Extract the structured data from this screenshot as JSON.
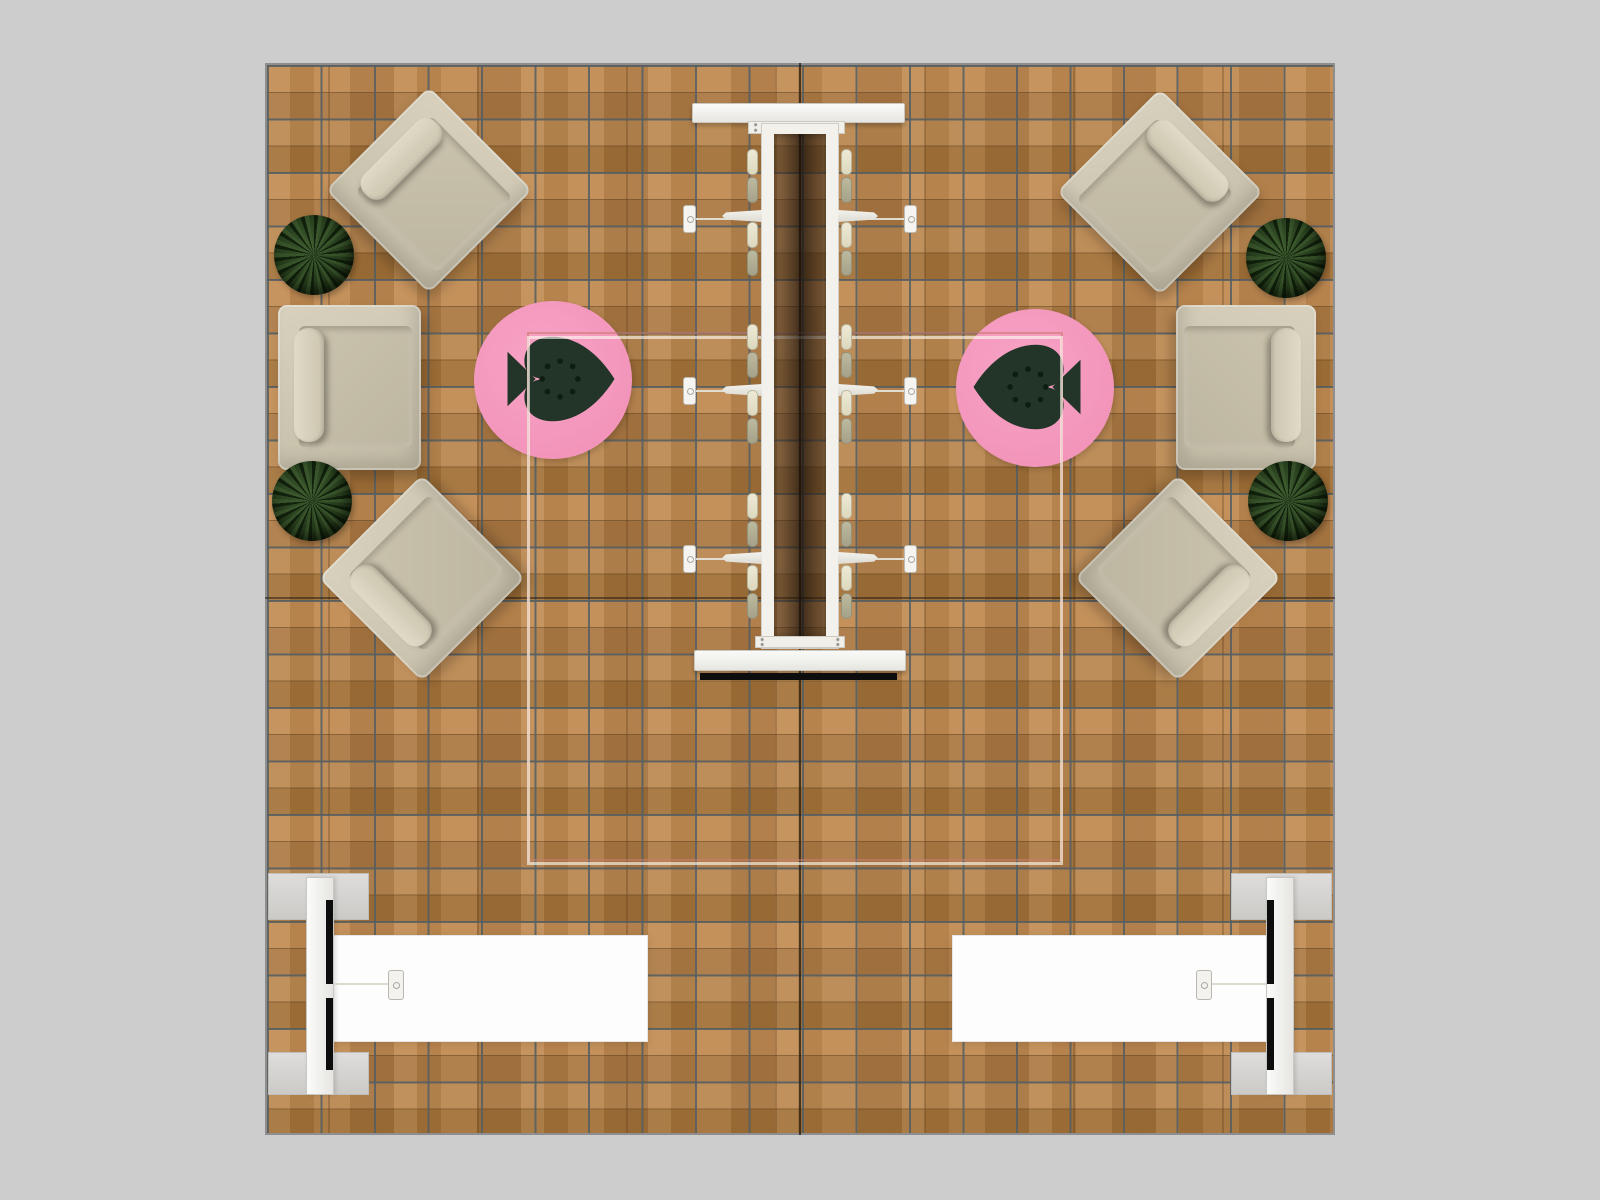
{
  "scene": {
    "kind": "booth-floorplan-render",
    "description": "Top-down orthographic render of a square exhibition booth / lounge floor plan on a gray surround",
    "floor": {
      "material": "wood-plank",
      "grid_tiles_x": 20,
      "grid_tiles_y": 20,
      "panel_seams": "dark cross seams at floor center"
    }
  },
  "inventory": {
    "corner_armchairs": 4,
    "side_armchairs": 2,
    "shrub_planters": 4,
    "round_logo_rugs": 2,
    "rug_logo": "spade-with-seed-dots",
    "rug_logo_orientation": [
      "tip-right",
      "tip-left"
    ],
    "central_counter": {
      "top_panels": 2,
      "rails": 2,
      "stools_per_side": 6,
      "stools_total": 12,
      "shelf_wings_per_side": 3,
      "wall_brackets_per_side": 3,
      "edge_on_display_strip": 1
    },
    "presentation_counters": 2,
    "edge_on_displays": 2,
    "display_stands": 2,
    "ceiling_frame_outline": 1
  },
  "colors": {
    "background": "#cdcdcd",
    "wood_mid": "#b2804a",
    "wood_light": "#c08a52",
    "wood_dark": "#a17038",
    "grid_line": "#545e63",
    "seam_dark": "#28201480",
    "chair_body": "#cbc4af",
    "chair_cushion": "#dcd6c3",
    "plant_mid": "#2a4220",
    "plant_dark": "#18270f",
    "rug_pink": "#f395bb",
    "logo_green": "#223528",
    "logo_dot": "#0e1c12",
    "structure_white": "#f2f1ec",
    "stool_cream": "#ddd9bd",
    "stool_olive": "#a5a289",
    "display_black": "#0d0d0d",
    "counter_white": "#fdfdfd",
    "unit_gray": "#d5d5d3",
    "ceiling_line_white": "#fffcf4",
    "ceiling_line_rose": "#c87d6e"
  }
}
